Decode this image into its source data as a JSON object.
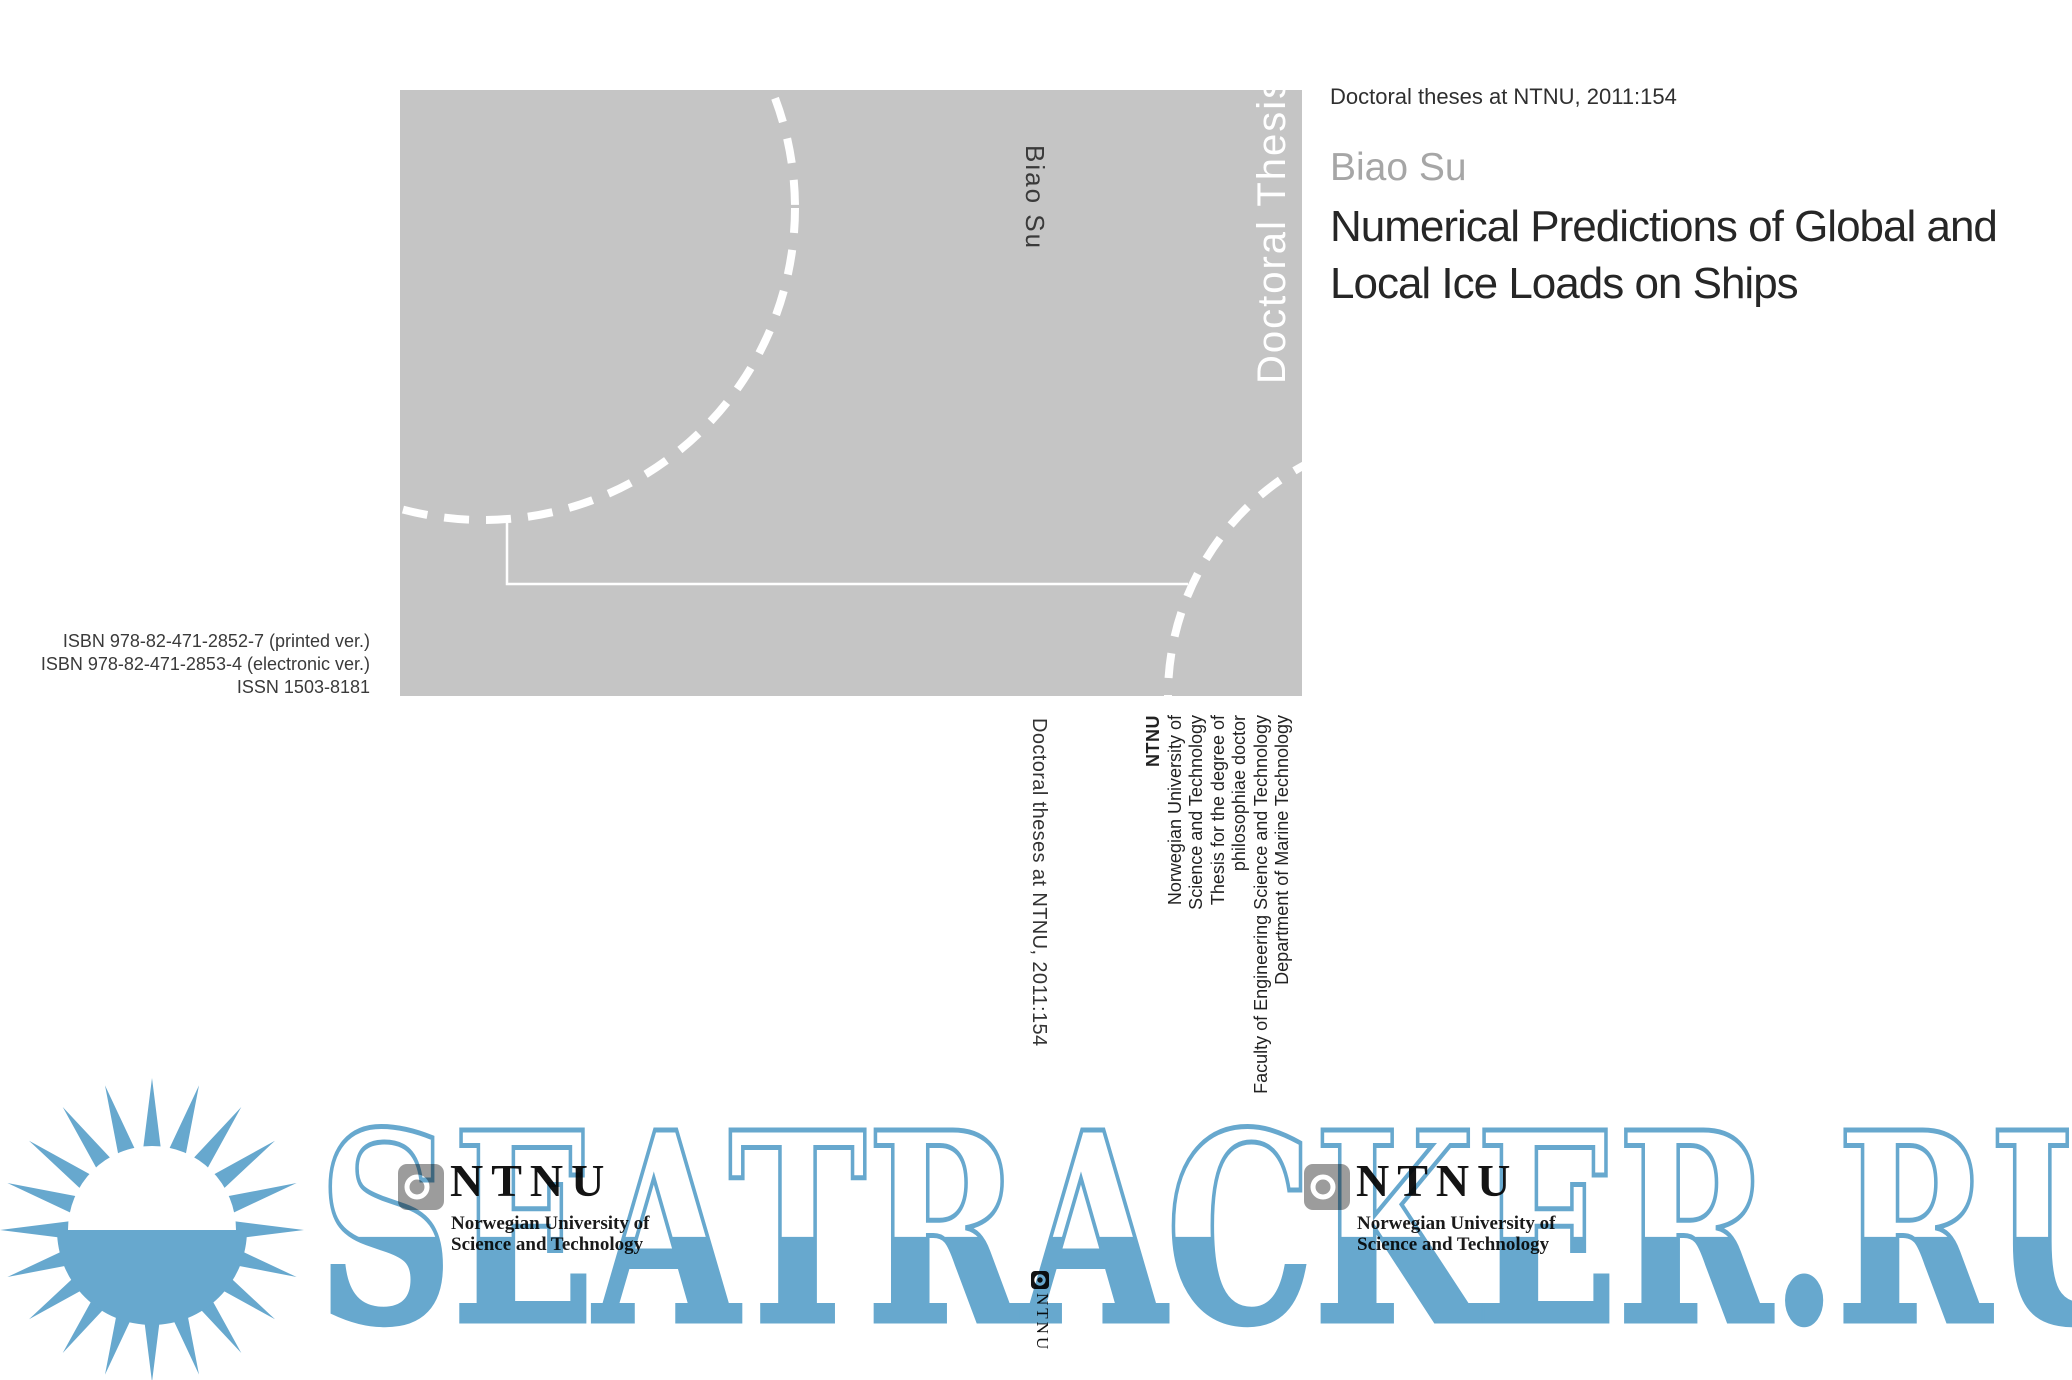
{
  "front_cover": {
    "series_header": "Doctoral theses at NTNU, 2011:154",
    "author": "Biao Su",
    "title_line1": "Numerical Predictions of Global and",
    "title_line2": "Local Ice Loads on Ships"
  },
  "cover_art": {
    "spine_author": "Biao Su",
    "spine_series": "Doctoral Thesis"
  },
  "back_cover": {
    "isbn_printed": "ISBN 978-82-471-2852-7 (printed ver.)",
    "isbn_electronic": "ISBN 978-82-471-2853-4 (electronic ver.)",
    "issn": "ISSN 1503-8181"
  },
  "fold": {
    "series_vertical": "Doctoral theses at NTNU, 2011:154",
    "institution_lines": [
      "NTNU",
      "Norwegian University of",
      "Science and Technology",
      "Thesis for the degree of",
      "philosophiae doctor",
      "Faculty of Engineering Science and Technology",
      "Department of Marine Technology"
    ]
  },
  "ntnu_logo": {
    "wordmark": "NTNU",
    "subtitle_line1": "Norwegian University of",
    "subtitle_line2": "Science and Technology"
  },
  "spine_logo": {
    "wordmark": "NTNU"
  },
  "watermark": {
    "text": "SEATRACKER.RU"
  },
  "colors": {
    "cover_gray": "#c5c5c5",
    "watermark_blue": "#67a8ce",
    "author_gray": "#a6a6a6",
    "title_dark": "#262626",
    "emblem_gray": "#9c9c9c"
  }
}
